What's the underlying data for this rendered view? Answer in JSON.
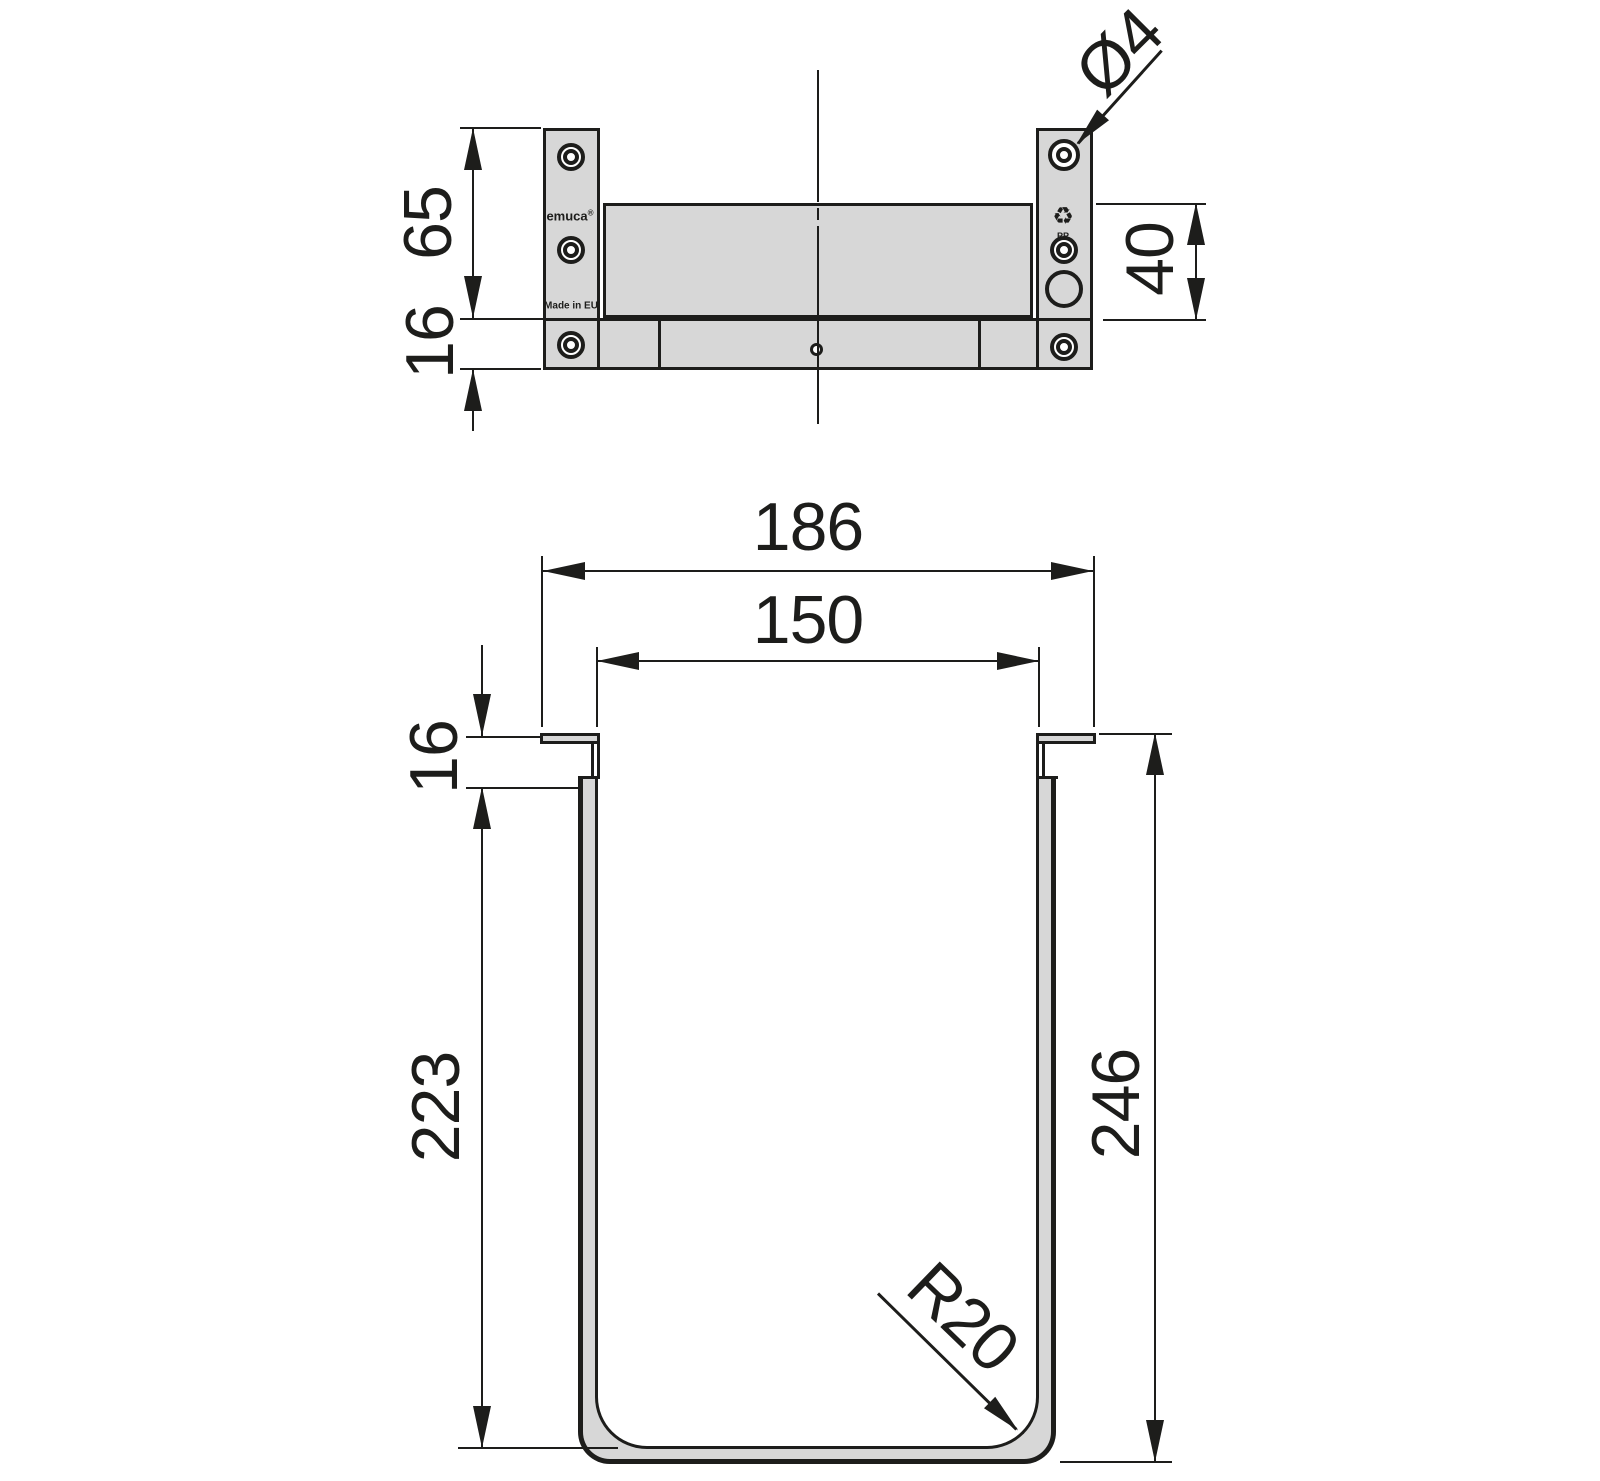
{
  "colors": {
    "line": "#1d1d1b",
    "fill_grey": "#d7d7d7",
    "background": "#ffffff"
  },
  "branding": {
    "logo_text": "emuca",
    "logo_mark": "®",
    "made_in": "Made in EU",
    "recycling_icon": "recycle-icon",
    "recycling_code": "PP"
  },
  "top_view": {
    "dim_bracket_height": "65",
    "dim_base_thickness": "16",
    "dim_hole_diameter": "Ø4",
    "dim_panel_height": "40"
  },
  "front_view": {
    "dim_outer_width": "186",
    "dim_inner_width": "150",
    "dim_rim_offset": "16",
    "dim_inner_depth": "223",
    "dim_outer_height": "246",
    "dim_corner_radius": "R20"
  }
}
